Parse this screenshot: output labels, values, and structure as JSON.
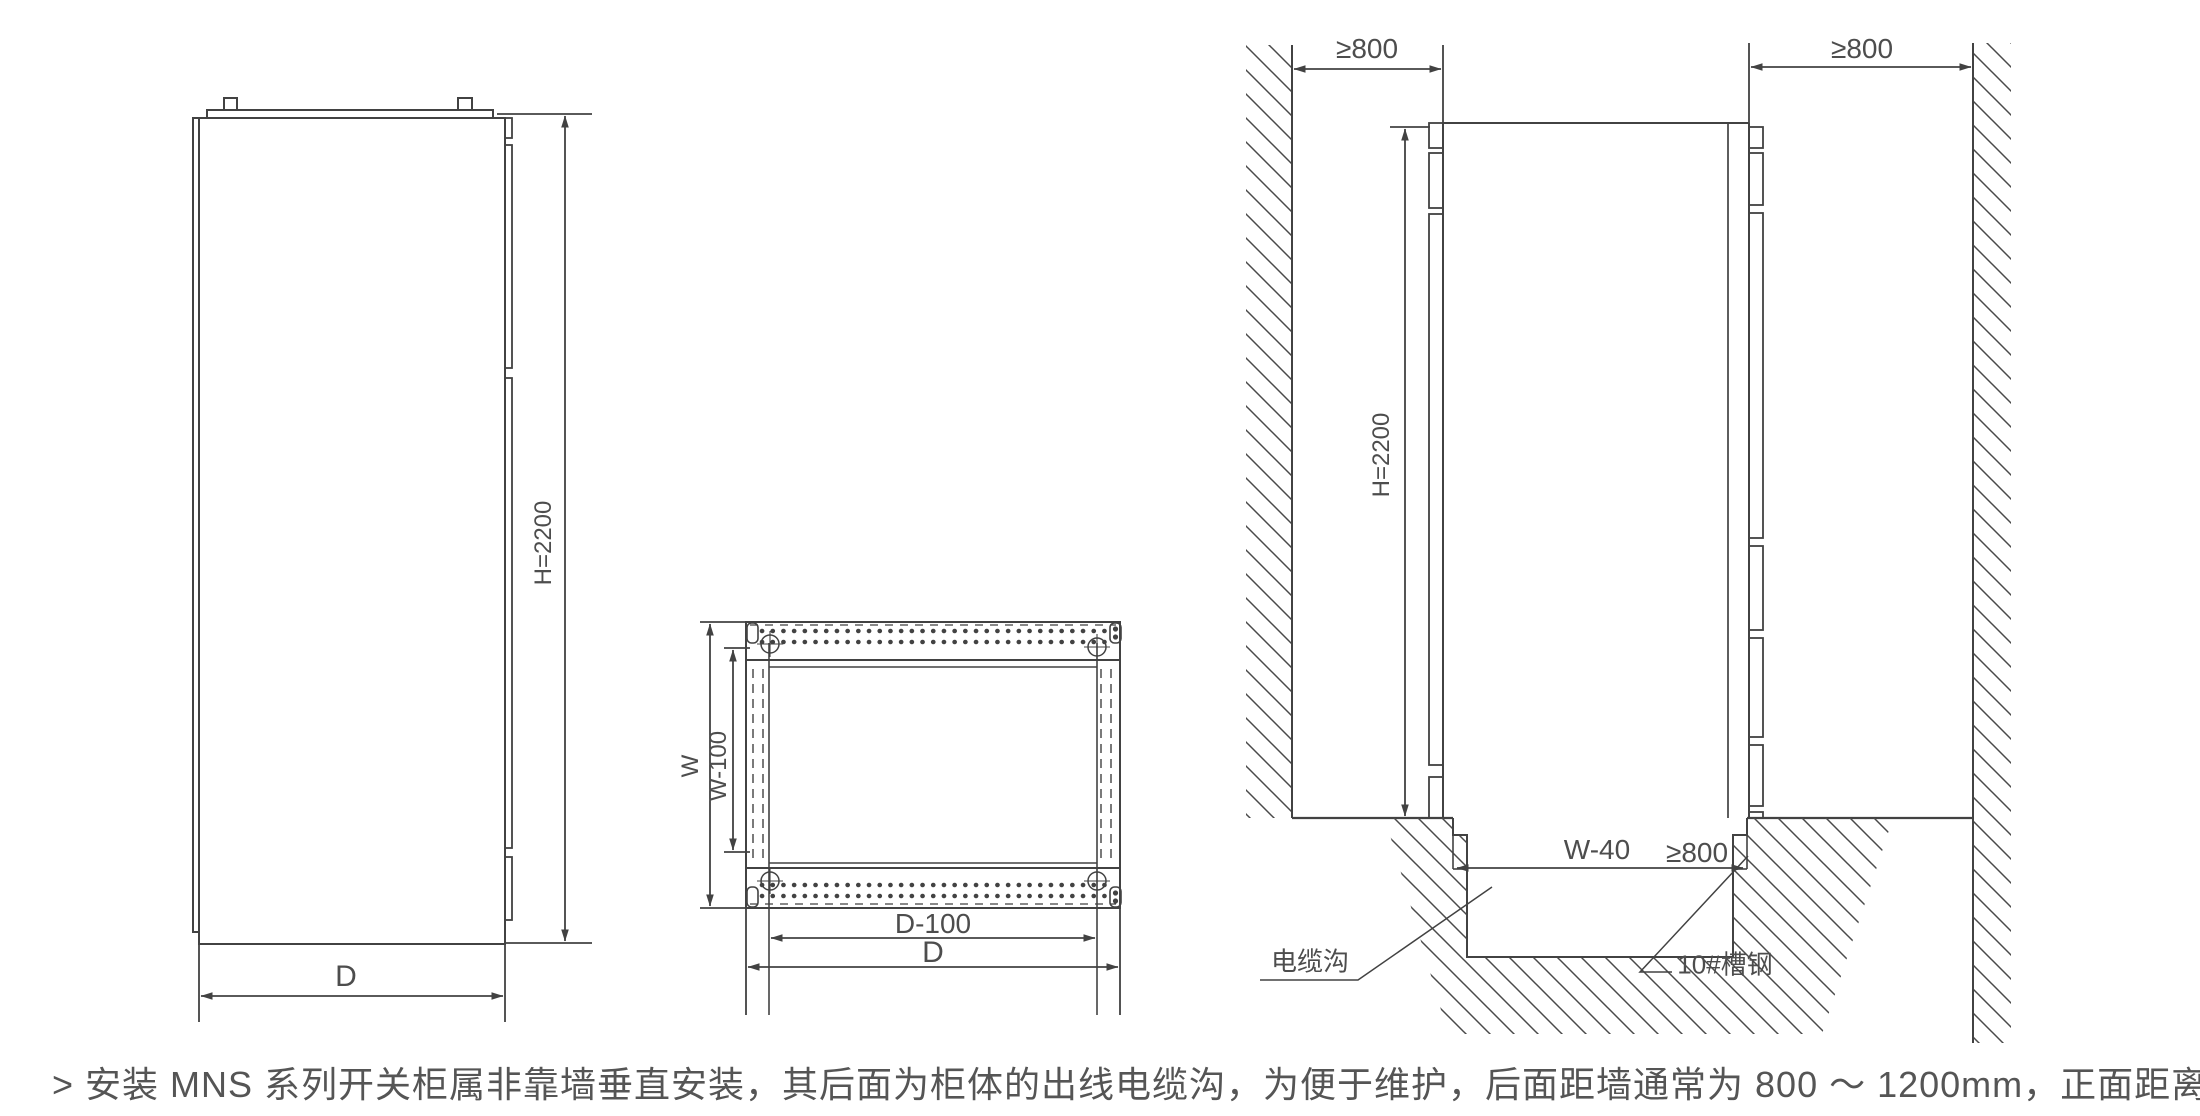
{
  "side_view": {
    "height_label": "H=2200",
    "depth_label": "D"
  },
  "plan_view": {
    "width_label": "W",
    "inner_width_label": "W-100",
    "inner_depth_label": "D-100",
    "depth_label": "D"
  },
  "install_view": {
    "rear_clearance_label": "≥800",
    "front_clearance_label": "≥800",
    "height_label": "H=2200",
    "trench_width_label": "W-40",
    "aisle_clearance_label": "≥800",
    "cable_trench_label": "电缆沟",
    "channel_steel_label": "10#槽钢"
  },
  "note": {
    "text": "> 安装 MNS 系列开关柜属非靠墙垂直安装，其后面为柜体的出线电缆沟，为便于维护，后面距墙通常为 800 ～ 1200mm，正面距离安装。"
  },
  "colors": {
    "line": "#424242",
    "text": "#4d4d4d",
    "background": "#ffffff"
  }
}
